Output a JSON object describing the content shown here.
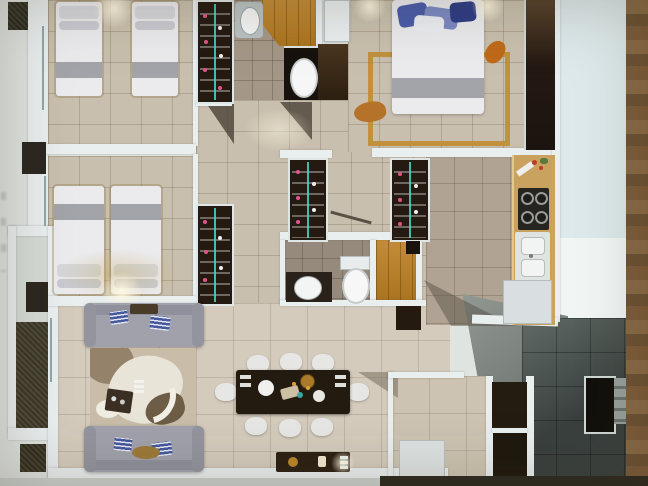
{
  "photo": {
    "description": "Photograph of a 3D-rendered top-down apartment floor plan on paper",
    "background": {
      "paper": "pale paper sheet visible top-right",
      "table_edge": "brown wood table surface visible along right edge",
      "legible_text": "none"
    }
  },
  "palette": {
    "outside": "#e0e4e1",
    "tile": "#c9bfae",
    "tile_light": "#d4cbbc",
    "tile_gray": "#a59787",
    "tile_kitchen": "#b1a393",
    "wall": "#e9eeef",
    "closet": "#241a12",
    "bed": "#ebebee",
    "bed_band": "#a3a4aa",
    "pillow_navy": "#46589e",
    "sofa": "#a0a1ab",
    "sofa_dark": "#8f909b",
    "chair": "#e6e7e5",
    "table_dark": "#231a10",
    "counter": "#c9a25f",
    "gold": "#c08c32",
    "orange": "#c06a1a",
    "accent_pink": "#e0568a",
    "accent_teal": "#49d8d0",
    "terrace_dark": "#39403e",
    "terrace_mid": "#616a66",
    "terrace_light": "#949a94",
    "planter": "#4f4a37",
    "paper": "#dde9eb",
    "paper_glare": "#f1f6f5",
    "wood_bg": "#77552f"
  },
  "apartment": {
    "rooms": [
      {
        "name": "bedroom-1",
        "furniture": [
          "twin-bed",
          "twin-bed",
          "wardrobe",
          "ceiling-light"
        ]
      },
      {
        "name": "bathroom-1",
        "furniture": [
          "sink",
          "toilet",
          "dark-cabinet"
        ]
      },
      {
        "name": "entry-hall",
        "furniture": [
          "wood-floor",
          "white-door-panel"
        ]
      },
      {
        "name": "master-bedroom",
        "furniture": [
          "double-bed",
          "blue-pillows",
          "wall-wardrobe",
          "gold-rug",
          "ceiling-light",
          "ceiling-light"
        ]
      },
      {
        "name": "kitchen",
        "furniture": [
          "counter",
          "stove-4-burners",
          "double-sink",
          "fridge"
        ]
      },
      {
        "name": "walk-in-closet-a",
        "furniture": [
          "hanging-clothes"
        ]
      },
      {
        "name": "walk-in-closet-b",
        "furniture": [
          "hanging-clothes"
        ]
      },
      {
        "name": "bedroom-2",
        "furniture": [
          "twin-bed",
          "twin-bed",
          "wardrobe",
          "ceiling-light"
        ]
      },
      {
        "name": "bathroom-2",
        "furniture": [
          "vanity-sink",
          "toilet"
        ]
      },
      {
        "name": "living-room",
        "furniture": [
          "sofa",
          "sofa",
          "abstract-area-rug",
          "coffee-table"
        ]
      },
      {
        "name": "dining-area",
        "furniture": [
          "dining-table",
          "eight-chairs",
          "sideboard",
          "lit-candle"
        ]
      },
      {
        "name": "utility-room",
        "furniture": [
          "washer-box"
        ]
      },
      {
        "name": "balcony-left",
        "furniture": [
          "dark-planters"
        ]
      },
      {
        "name": "terrace",
        "furniture": [
          "dark-tile-floor",
          "doorway",
          "steps"
        ]
      }
    ],
    "counts": {
      "twin_beds": 4,
      "double_beds": 1,
      "sofas": 2,
      "dining_chairs": 8,
      "stove_burners": 4,
      "walk_in_closets": 2
    }
  }
}
